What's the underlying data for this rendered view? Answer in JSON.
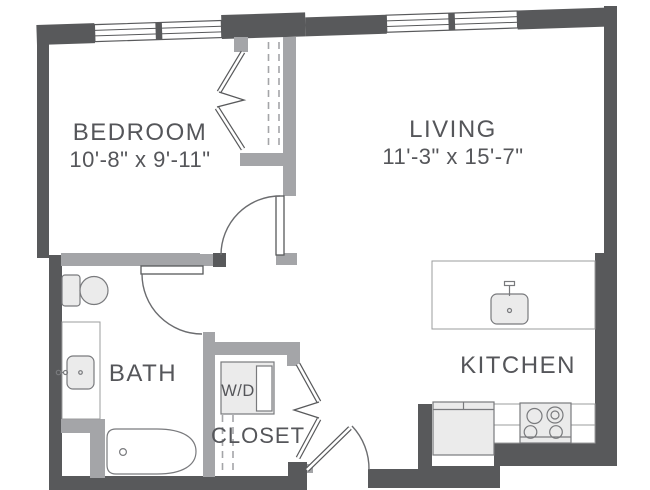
{
  "plan": {
    "type": "apartment-floor-plan",
    "rooms": {
      "bedroom": {
        "name": "BEDROOM",
        "dimensions": "10'-8\" x 9'-11\""
      },
      "living": {
        "name": "LIVING",
        "dimensions": "11'-3\" x 15'-7\""
      },
      "bath": {
        "name": "BATH"
      },
      "kitchen": {
        "name": "KITCHEN"
      },
      "closet": {
        "name": "CLOSET"
      },
      "washer_dryer": {
        "name": "W/D"
      }
    },
    "fixtures": [
      "toilet",
      "vanity-sink",
      "bathtub",
      "washer-dryer-unit",
      "kitchen-island-sink",
      "refrigerator",
      "stove",
      "windows",
      "swing-doors",
      "bifold-closet-doors"
    ]
  },
  "theme": {
    "background": "#ffffff",
    "wall-dark": "#58595b",
    "wall-light": "#a4a5a8",
    "fixture-fill": "#ebebeb",
    "fixture-stroke": "#797a7d",
    "counter-stroke": "#9b9c9e",
    "door-stroke": "#6b6c6f",
    "label-color": "#55565a"
  }
}
